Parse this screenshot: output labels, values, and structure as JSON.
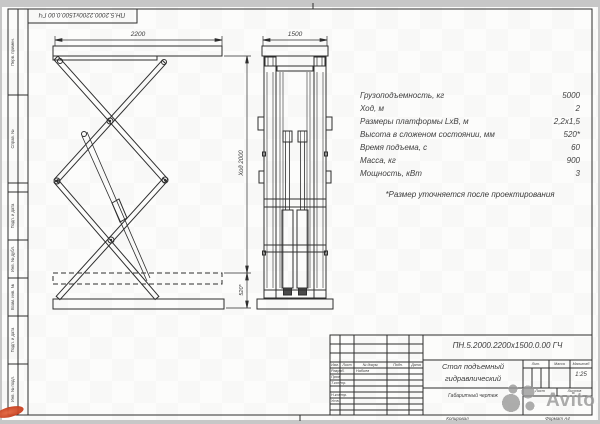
{
  "colors": {
    "bg": "#c7c7c7",
    "sheet": "#fcfcfb",
    "line": "#2e2e2e",
    "text": "#3a3a3a",
    "watermark": "#969696",
    "red_mark": "#c63f1f"
  },
  "frame": {
    "top_stamp_doc_number": "ПН.5.2000.2200х1500.0.00 ГЧ",
    "margin_labels": [
      "Перв. примен.",
      "Справ. №",
      "Подп. и дата",
      "Инв. № дубл.",
      "Взам. инв. №",
      "Подп. и дата",
      "Инв. № подл."
    ]
  },
  "views": {
    "side_view": {
      "width_dim": "2200",
      "stroke_dim": "Ход 2000",
      "folded_dim": "520*"
    },
    "front_view": {
      "width_dim": "1500"
    }
  },
  "specs": {
    "rows": [
      {
        "label": "Грузоподъемность, кг",
        "value": "5000"
      },
      {
        "label": "Ход, м",
        "value": "2"
      },
      {
        "label": "Размеры платформы LxB, м",
        "value": "2,2x1,5"
      },
      {
        "label": "Высота в сложеном состоянии, мм",
        "value": "520*"
      },
      {
        "label": "Время подъема, с",
        "value": "60"
      },
      {
        "label": "Масса, кг",
        "value": "900"
      },
      {
        "label": "Мощность, кВт",
        "value": "3"
      }
    ],
    "footnote": "*Размер уточняется после проектирования"
  },
  "title_block": {
    "doc_number": "ПН.5.2000.2200х1500.0.00 ГЧ",
    "title_line1": "Стол подъемный",
    "title_line2": "гидравлический",
    "subtitle": "Габаритный чертеж",
    "header_cols": [
      "Изм.",
      "Лист",
      "№ докум.",
      "Подп.",
      "Дата"
    ],
    "rows": [
      "Разраб.",
      "Пров.",
      "Т.контр.",
      "Н.контр.",
      "Утв."
    ],
    "designer": "Набиев",
    "lit_label": "Лит.",
    "mass_label": "Масса",
    "scale_label": "Масштаб",
    "scale": "1:25",
    "sheet_label": "Лист",
    "sheets_label": "Листов",
    "copied_label": "Копировал",
    "format_label": "Формат А4"
  },
  "watermark": {
    "brand": "Avito"
  }
}
